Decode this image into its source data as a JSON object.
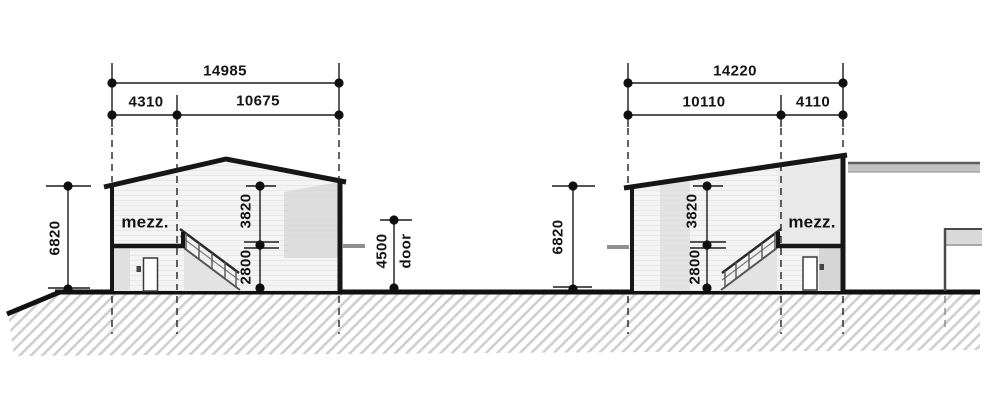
{
  "drawing_title": "building cross-sections with mezzanines",
  "left_building": {
    "mezz_label": "mezz.",
    "width_total": "14985",
    "width_mezz": "4310",
    "width_main": "10675",
    "height_total": "6820",
    "height_upper": "3820",
    "height_lower": "2800"
  },
  "gap": {
    "door_height": "4500",
    "door_label": "door"
  },
  "right_building": {
    "mezz_label": "mezz.",
    "width_total": "14220",
    "width_main": "10110",
    "width_mezz": "4110",
    "height_total": "6820",
    "height_upper": "3820",
    "height_lower": "2800"
  },
  "colors": {
    "line": "#161616",
    "hatch": "#cfcfcf",
    "interior": "#f4f4f4",
    "shade": "#d6d6d6"
  }
}
